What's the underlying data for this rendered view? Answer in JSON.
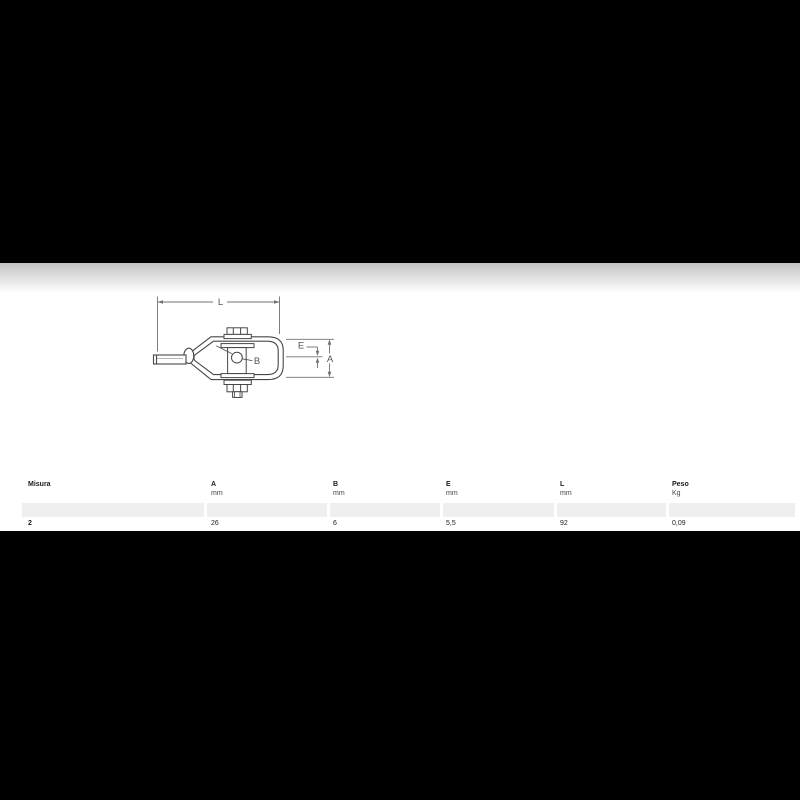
{
  "page": {
    "background_color": "#000000",
    "content_background": "#ffffff",
    "stripe_color": "#efefef"
  },
  "drawing": {
    "description": "wire-strainer-technical-drawing",
    "line_color": "#474747",
    "dimension_color": "#707070",
    "labels": {
      "length": "L",
      "slot": "E",
      "height": "A",
      "hole": "B"
    }
  },
  "table": {
    "columns": [
      {
        "label": "Misura",
        "unit": ""
      },
      {
        "label": "A",
        "unit": "mm"
      },
      {
        "label": "B",
        "unit": "mm"
      },
      {
        "label": "E",
        "unit": "mm"
      },
      {
        "label": "L",
        "unit": "mm"
      },
      {
        "label": "Peso",
        "unit": "Kg"
      }
    ],
    "rows": [
      {
        "misura": "2",
        "a": "26",
        "b": "6",
        "e": "5,5",
        "l": "92",
        "peso": "0,09"
      }
    ]
  }
}
